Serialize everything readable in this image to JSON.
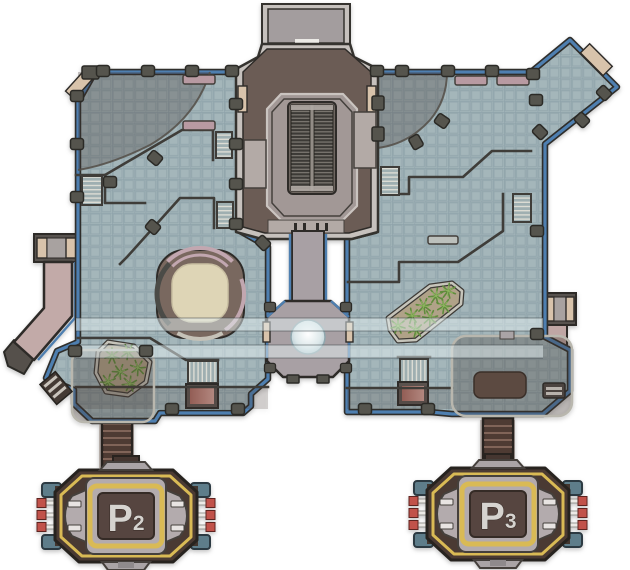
{
  "map": {
    "background": "#ffffff",
    "capture_points": [
      {
        "id": "P2",
        "label": "P",
        "sub": "2"
      },
      {
        "id": "P3",
        "label": "P",
        "sub": "3"
      }
    ],
    "palette": {
      "floor": "#a4b6ba",
      "floor_grid": "#8da1a9",
      "edge_blue": "#4e7fb0",
      "outline_dark": "#2f2e2b",
      "structure_brown": "#6b5c55",
      "structure_trim": "#c6c1bd",
      "structure_inner": "#a29896",
      "escalator_belt": "#3c3a36",
      "corridor_pink": "#c2aaa8",
      "door_tan": "#d8c3ab",
      "glass_walkway": "#e4f0f2",
      "shadow_overlay": "#42342d",
      "planter_dirt": "#b0a288",
      "grass_green": "#5f8c3c",
      "kiosk_brown": "#79685f",
      "kiosk_cream": "#ded5b6",
      "fountain_blue": "#b4c9d0",
      "point_brown": "#4a3a33",
      "point_trim_yellow": "#d9ba55",
      "point_gray": "#b3abad",
      "point_tab_slate": "#5e7d8a",
      "pin_red": "#c1524a",
      "stairs_dark_brown": "#4e3b33",
      "wall_dark": "#3f3d39",
      "bench_mauve": "#b89aa2",
      "label_text": "#d6d3cf"
    },
    "features": [
      "top-entrance",
      "escalator",
      "central-corridor",
      "fountain-circle",
      "round-kiosk",
      "planter-left",
      "planter-right",
      "glass-walkway",
      "left-ramp",
      "right-corridor",
      "capture-point-p2",
      "capture-point-p3"
    ]
  }
}
